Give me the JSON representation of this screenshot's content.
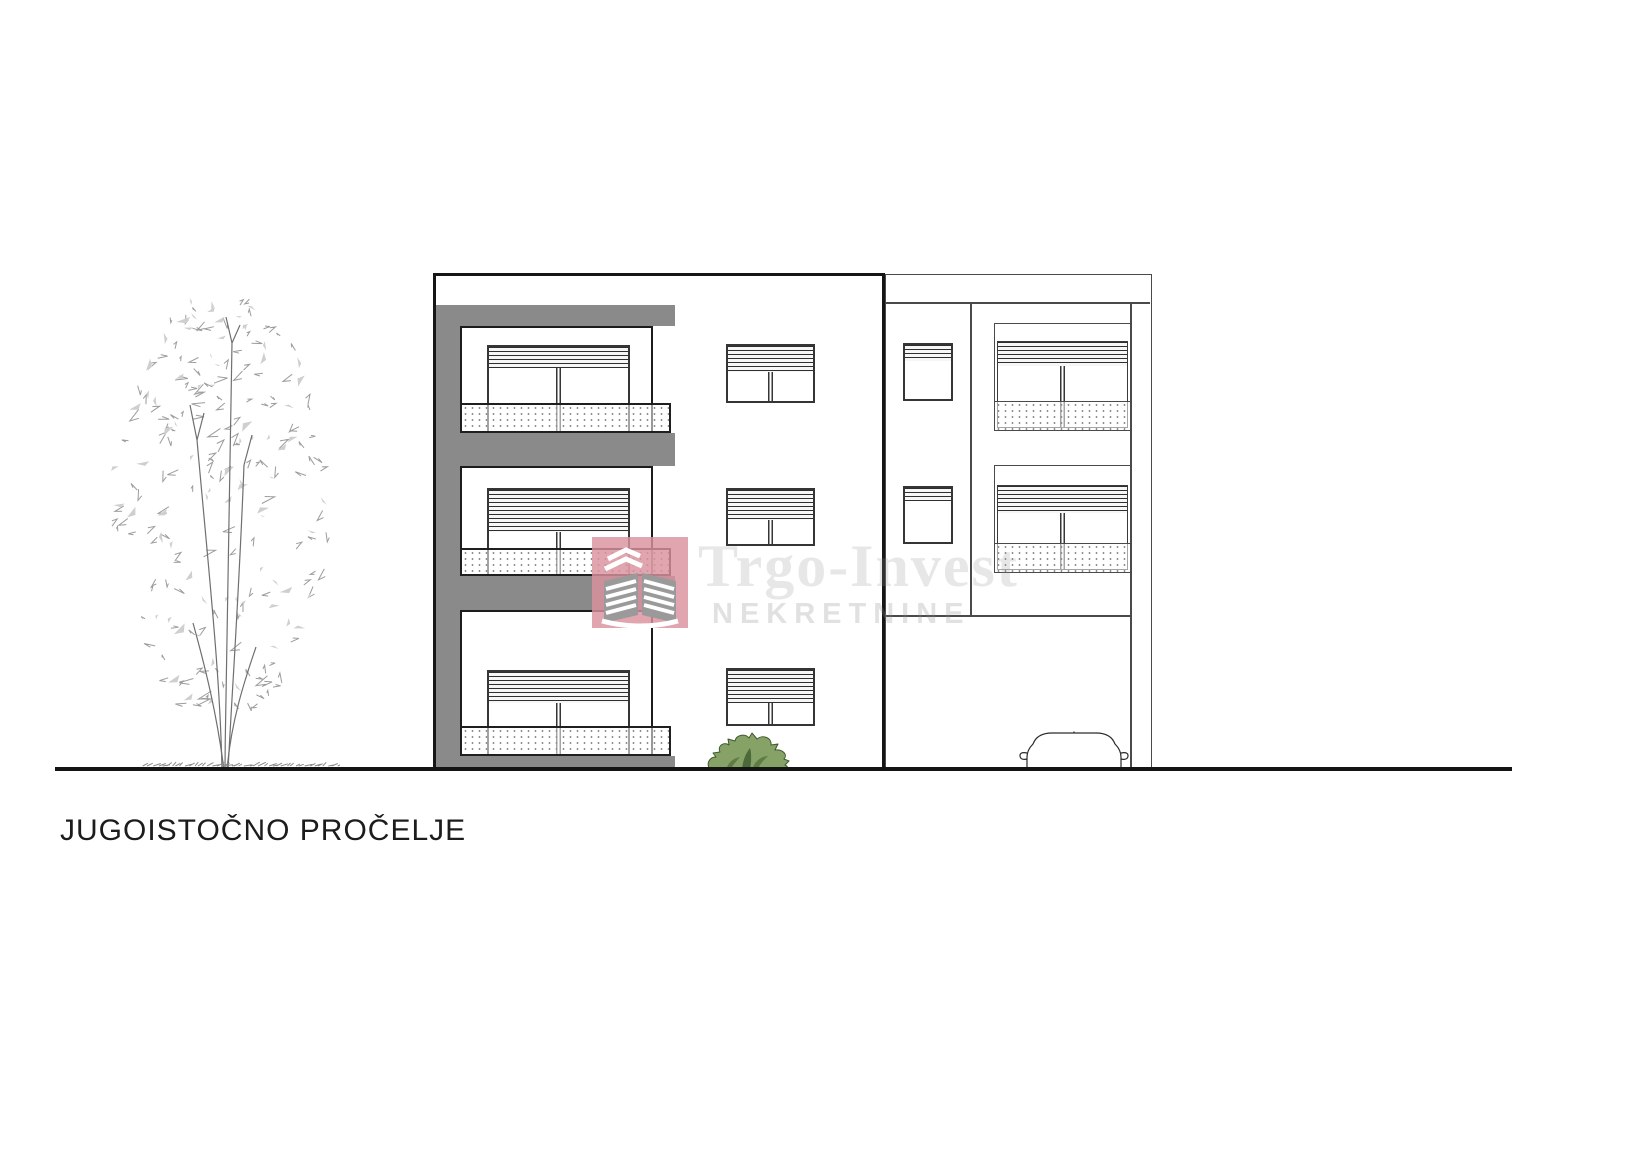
{
  "page": {
    "title": "JUGOISTOČNO PROČELJE"
  },
  "watermark": {
    "company": "Trgo-Invest",
    "subtitle": "NEKRETNINE",
    "logo_color": "#d9919c"
  },
  "colors": {
    "facade_accent_gray": "#8a8a8a",
    "outline_black": "#161616",
    "bush_green": "#87a266",
    "bush_dark_green": "#5e7d45",
    "tree_sketch_gray": "#9c9c9c",
    "watermark_text_gray": "rgba(145,145,145,0.22)"
  }
}
